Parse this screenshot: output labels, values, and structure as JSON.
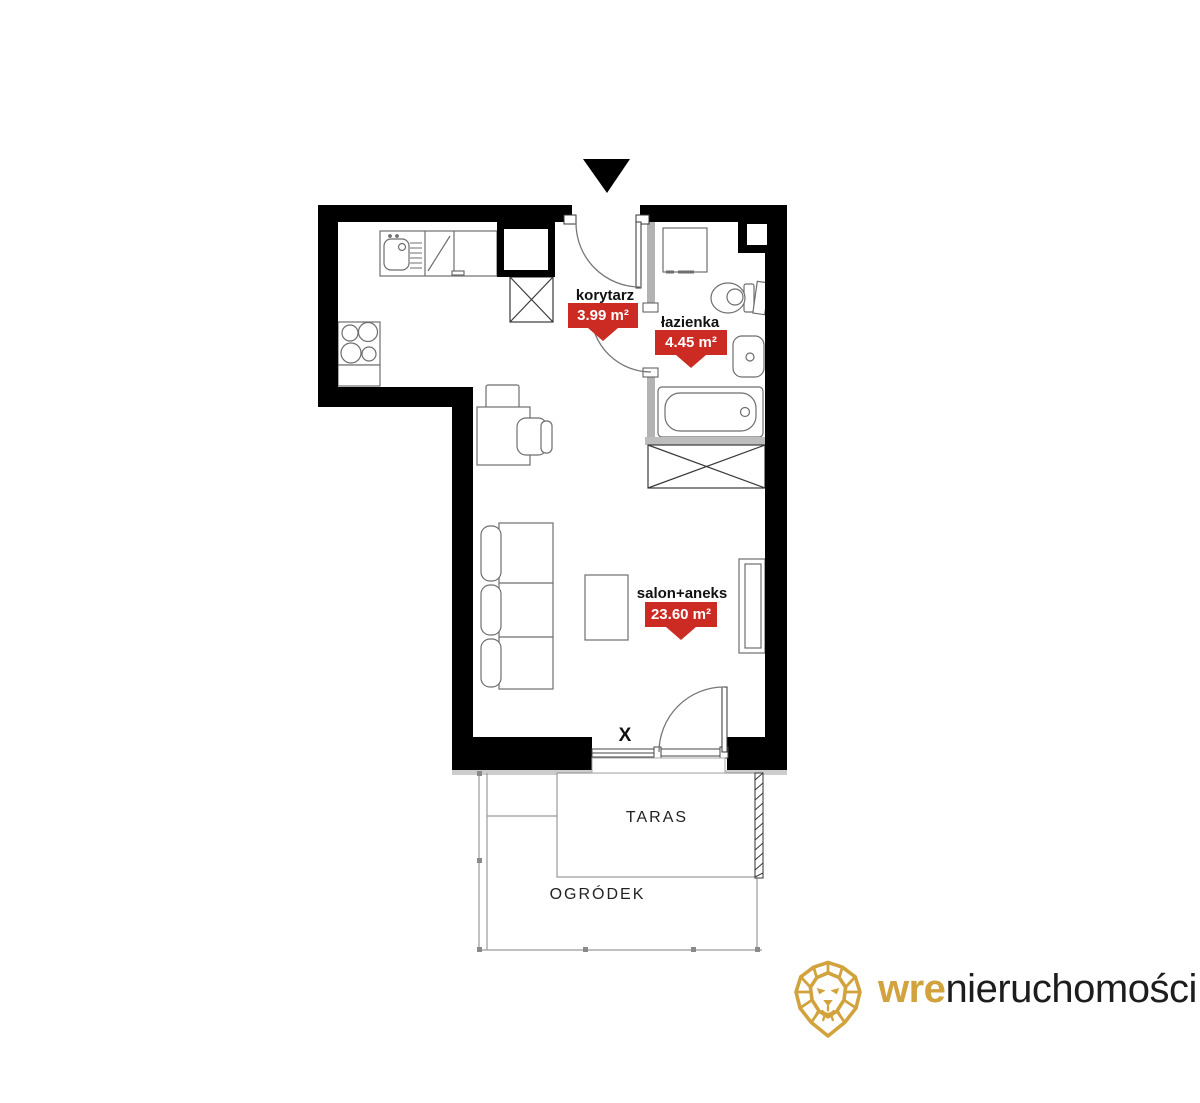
{
  "plan": {
    "rooms": [
      {
        "id": "korytarz",
        "name": "korytarz",
        "area": "3.99 m²"
      },
      {
        "id": "lazienka",
        "name": "łazienka",
        "area": "4.45 m²"
      },
      {
        "id": "salon",
        "name": "salon+aneks",
        "area": "23.60 m²"
      }
    ],
    "outdoor": {
      "taras": "TARAS",
      "ogrodek": "OGRÓDEK"
    },
    "window_marker": "X"
  },
  "branding": {
    "logo_bold": "wre",
    "logo_rest": "nieruchomości"
  },
  "colors": {
    "area_tag_red": "#cc2b23",
    "logo_gold": "#d2a23d",
    "wall_black": "#000000"
  }
}
